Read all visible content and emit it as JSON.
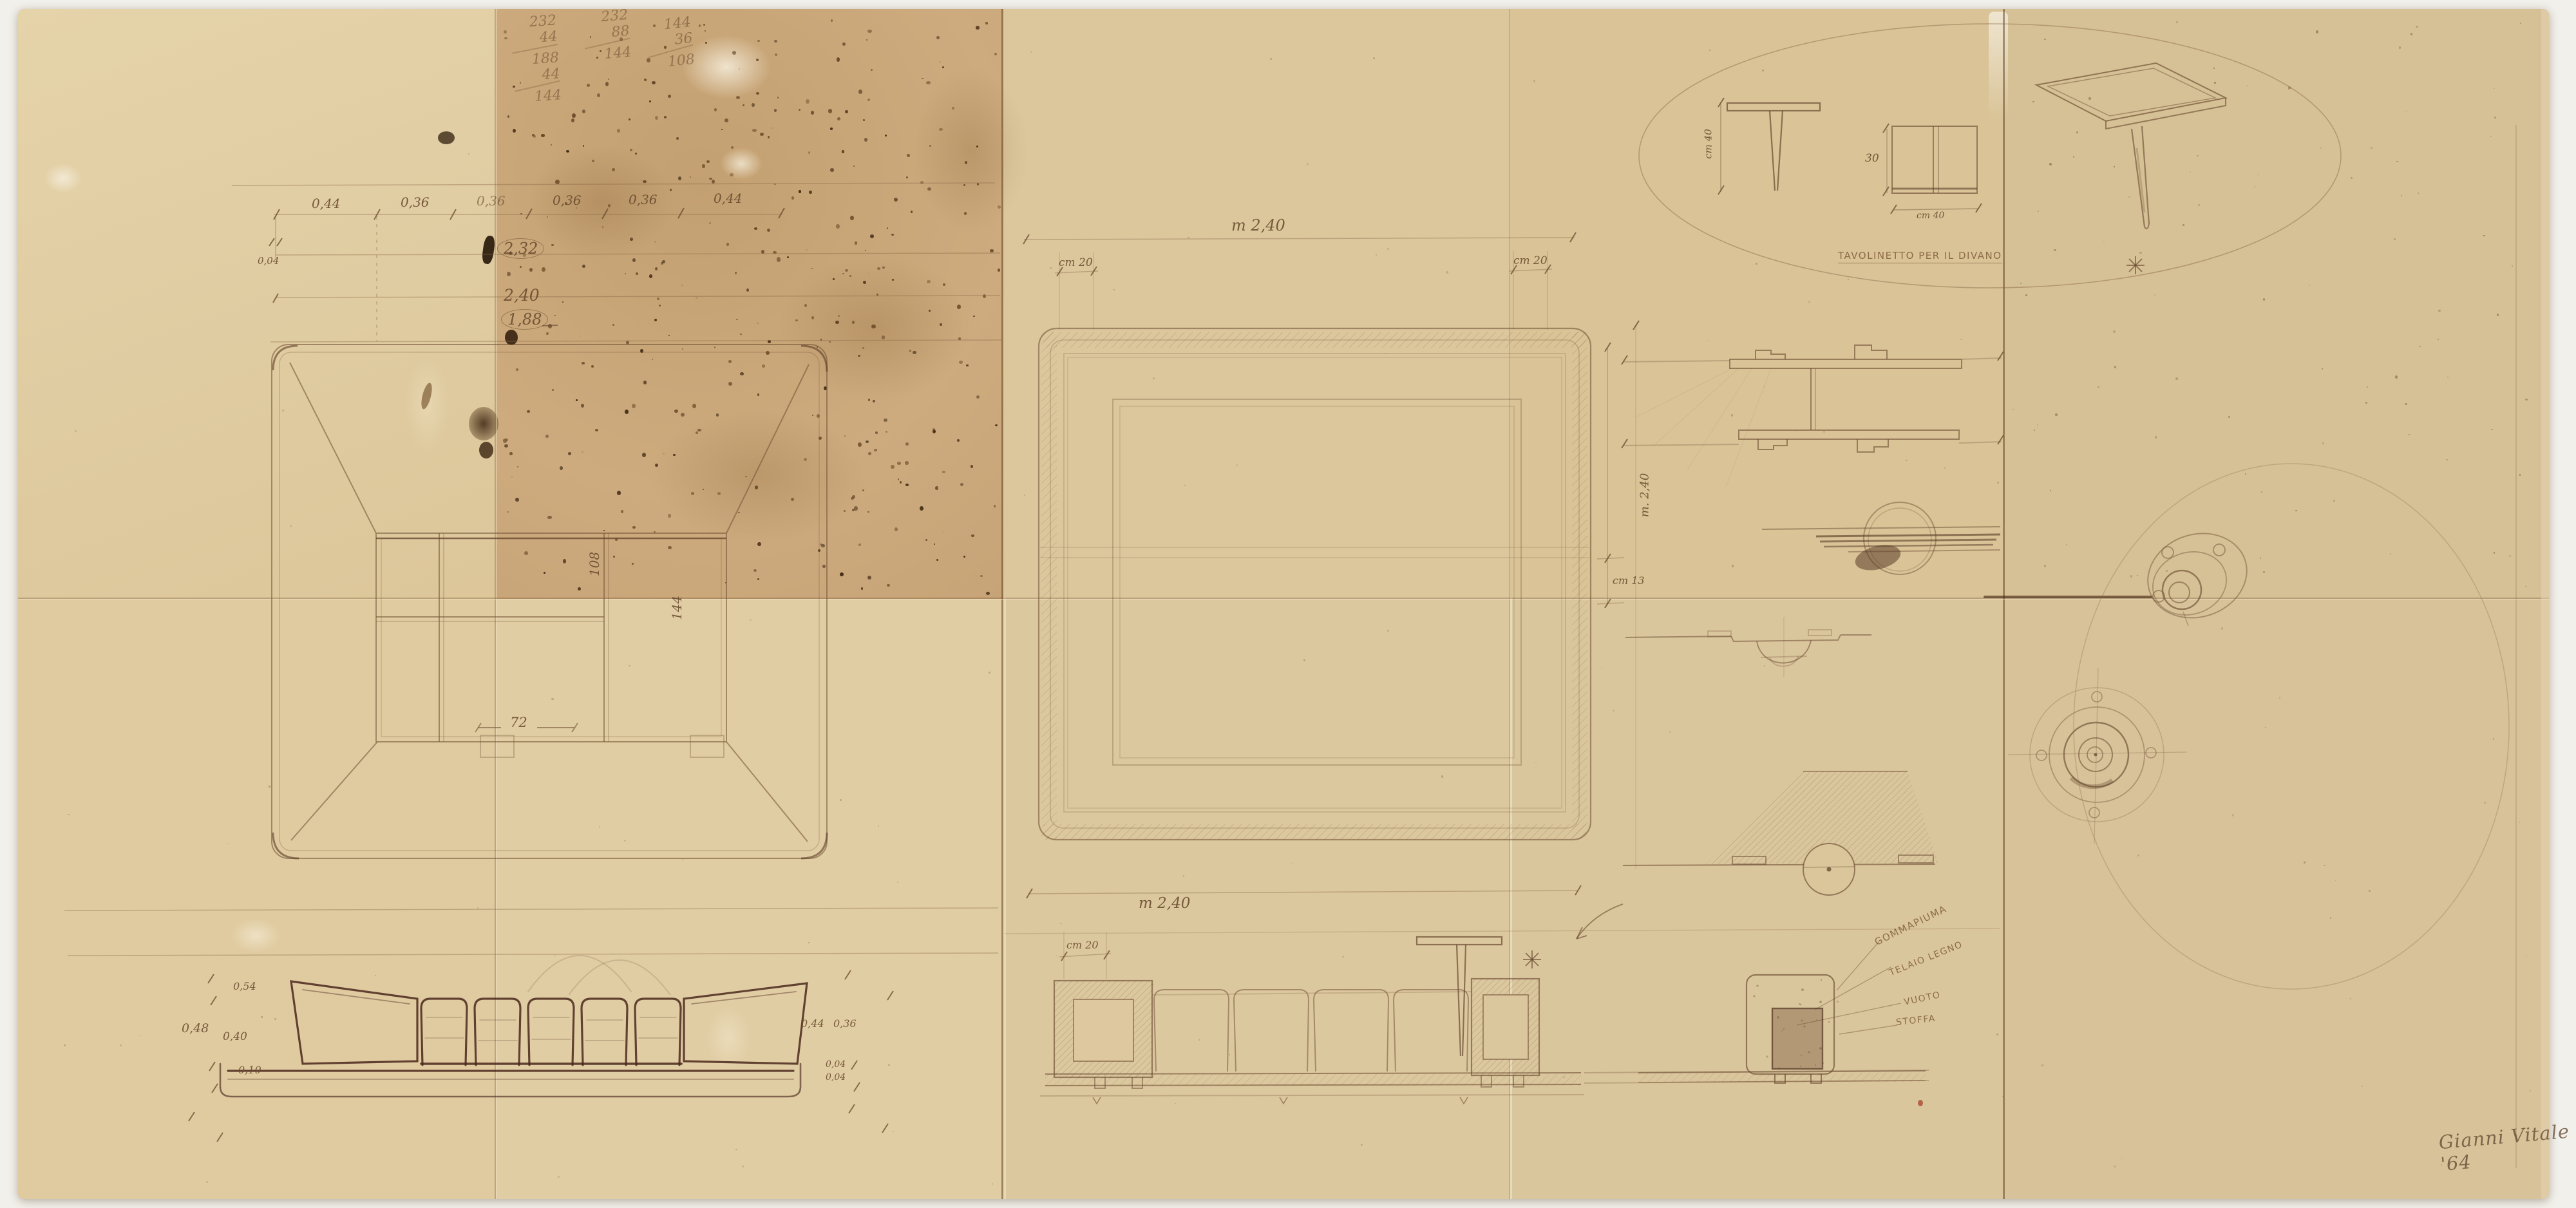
{
  "sheet": {
    "description": "Pencil design drawing for a square sofa group on aged folded paper",
    "signature": "Gianni Vitale '64"
  },
  "calc": {
    "col1": [
      "232",
      "44",
      "188",
      "44",
      "144"
    ],
    "col2": [
      "232",
      "88",
      "144"
    ],
    "col3": [
      "144",
      "36",
      "108"
    ]
  },
  "left_plan": {
    "chain": [
      "0,44",
      "0,36",
      "0,36",
      "0,36",
      "0,36",
      "0,44"
    ],
    "total_circled": "2,32",
    "total_mid": "2,40",
    "inner_circled": "1,88",
    "dash": "—",
    "small": "0,04",
    "label_108": "108",
    "label_144": "144",
    "label_72": "72"
  },
  "center_plan": {
    "top_dim": "m 2,40",
    "left_offset": "cm 20",
    "right_offset": "cm 20",
    "side_dim": "m. 2,40",
    "side_offset": "cm 13"
  },
  "tavolinetto": {
    "caption": "TAVOLINETTO PER IL DIVANO",
    "side_height": "cm 40",
    "front_height": "30",
    "front_width": "cm 40"
  },
  "elevation_left": {
    "d054": "0,54",
    "d048": "0,48",
    "d040": "0,40",
    "d010": "0,10",
    "d044": "0,44",
    "d036": "0,36",
    "d004a": "0,04",
    "d004b": "0,04"
  },
  "elevation_center": {
    "top_dim": "m 2,40",
    "offset": "cm 20"
  },
  "materials": {
    "foam": "GOMMAPIUMA",
    "frame": "TELAIO LEGNO",
    "void": "VUOTO",
    "fabric": "STOFFA"
  }
}
